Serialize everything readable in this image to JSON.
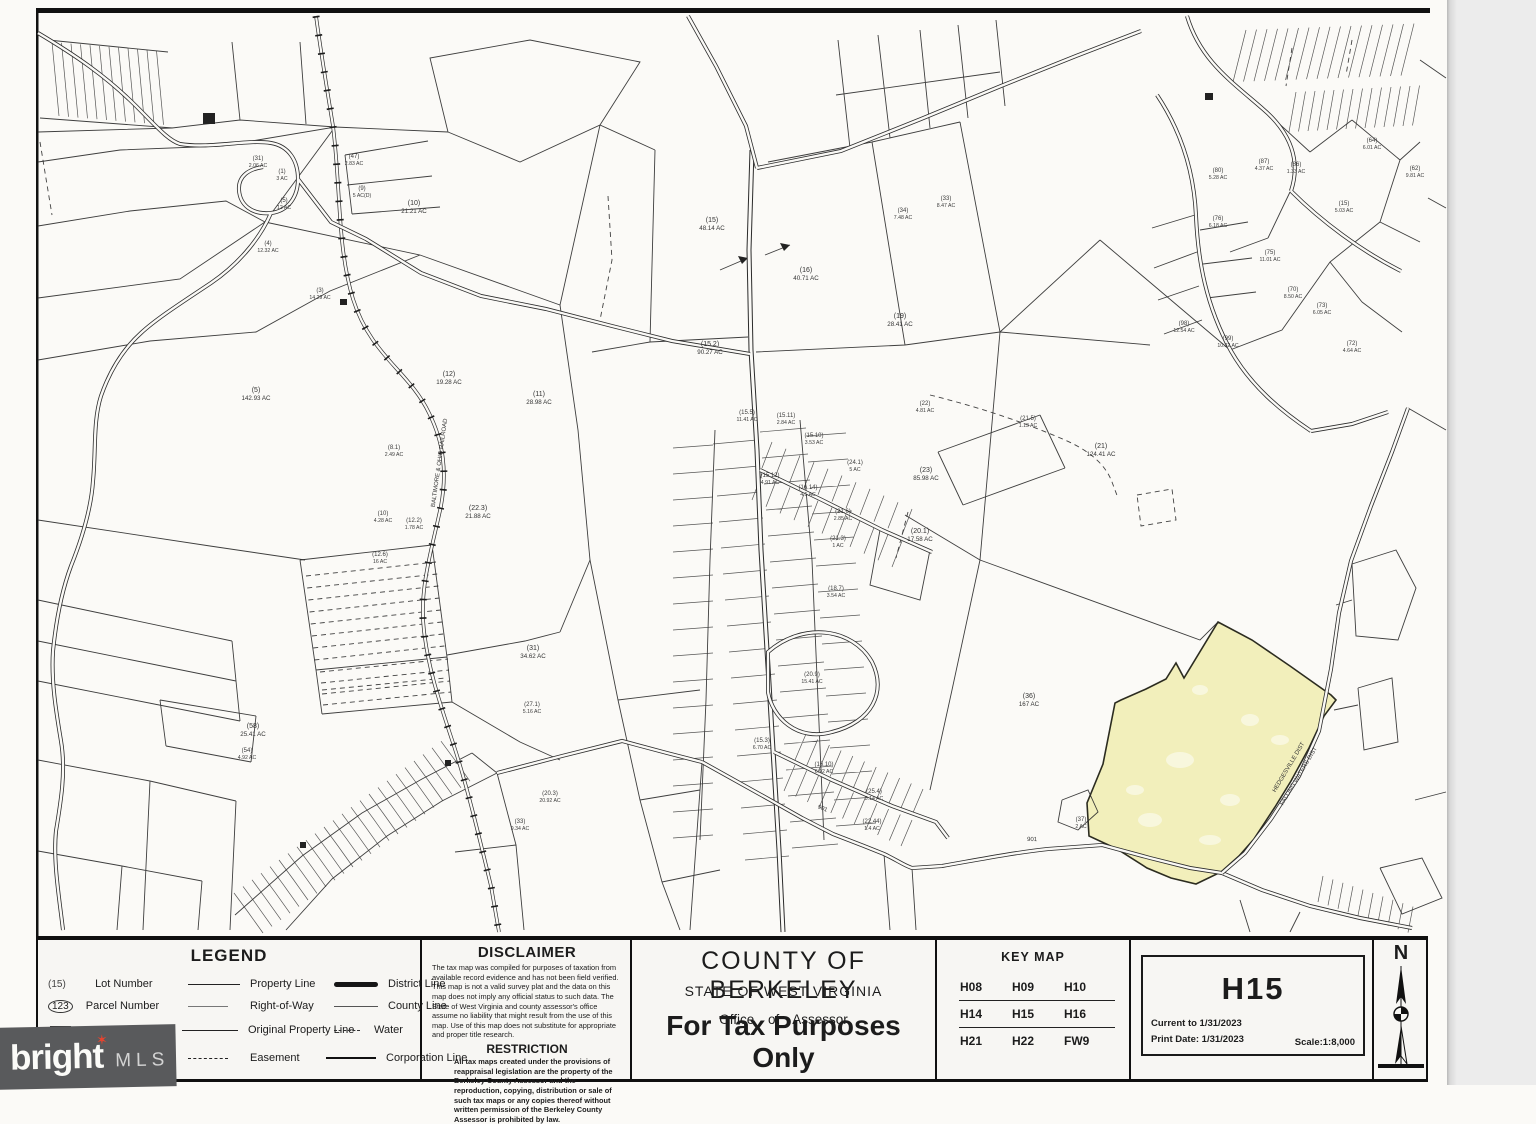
{
  "legend": {
    "title": "LEGEND",
    "symbols": [
      {
        "sym": "(15)",
        "label": "Lot Number"
      },
      {
        "sym": "123",
        "label": "Parcel Number"
      },
      {
        "sym": "12",
        "label": "Block Number"
      }
    ],
    "lines": [
      {
        "label": "Property Line"
      },
      {
        "label": "Right-of-Way"
      },
      {
        "label": "Original Property Line"
      },
      {
        "label": "Easement"
      }
    ],
    "lines2": [
      {
        "label": "District Line"
      },
      {
        "label": "County Line"
      },
      {
        "label": "Water"
      },
      {
        "label": "Corporation Line"
      }
    ]
  },
  "disclaimer": {
    "title": "DISCLAIMER",
    "body": "The tax map was compiled for purposes of taxation from available record evidence and has not been field verified.  This map is not a valid survey plat and the data on this map does not imply any official status to such data.  The State of West Virginia and county assessor's office assume no liability that might result from the use of this map. Use of this map does not substitute for appropriate and proper title research.",
    "restriction_title": "RESTRICTION",
    "restriction_body": "All tax maps created under the provisions of reappraisal legislation are the property of the Berkeley County Assessor and the reproduction, copying, distribution or sale of such tax maps or any copies thereof without written permission of the Berkeley County Assessor is prohibited by law."
  },
  "title_block": {
    "county": "COUNTY OF BERKELEY",
    "state": "STATE OF WEST VIRGINIA",
    "office": "Office of Assessor",
    "tax_note": "For Tax Purposes Only"
  },
  "key_map": {
    "title": "KEY MAP",
    "rows": [
      [
        "H08",
        "H09",
        "H10"
      ],
      [
        "H14",
        "H15",
        "H16"
      ],
      [
        "H21",
        "H22",
        "FW9"
      ]
    ]
  },
  "sheet": {
    "id": "H15",
    "current_to": "Current to 1/31/2023",
    "print_date": "Print Date: 1/31/2023",
    "scale": "Scale:1:8,000"
  },
  "north": {
    "label": "N"
  },
  "watermark": {
    "brand": "bright",
    "suffix": "MLS"
  },
  "map": {
    "highlight_color": "#f2efbb",
    "parcel_labels": [
      {
        "n": "(31)",
        "a": "2.06 AC",
        "x": 258,
        "y": 160
      },
      {
        "n": "(1)",
        "a": "3 AC",
        "x": 282,
        "y": 173
      },
      {
        "n": "(5)",
        "a": "12 AC",
        "x": 284,
        "y": 202
      },
      {
        "n": "(4)",
        "a": "12.32 AC",
        "x": 268,
        "y": 245
      },
      {
        "n": "(3)",
        "a": "14.29 AC",
        "x": 320,
        "y": 292
      },
      {
        "n": "(47)",
        "a": "2.83 AC",
        "x": 354,
        "y": 158
      },
      {
        "n": "(9)",
        "a": "5 AC(D)",
        "x": 362,
        "y": 190
      },
      {
        "n": "(10)",
        "a": "21.21 AC",
        "x": 414,
        "y": 205,
        "b": 1
      },
      {
        "n": "(5)",
        "a": "142.93 AC",
        "x": 256,
        "y": 392,
        "b": 1
      },
      {
        "n": "(12)",
        "a": "19.28 AC",
        "x": 449,
        "y": 376,
        "b": 1
      },
      {
        "n": "(11)",
        "a": "28.98 AC",
        "x": 539,
        "y": 396,
        "b": 1
      },
      {
        "n": "(8.1)",
        "a": "2.49 AC",
        "x": 394,
        "y": 449
      },
      {
        "n": "(10)",
        "a": "4.28 AC",
        "x": 383,
        "y": 515
      },
      {
        "n": "(12.2)",
        "a": "1.78 AC",
        "x": 414,
        "y": 522
      },
      {
        "n": "(22.3)",
        "a": "21.88 AC",
        "x": 478,
        "y": 510,
        "b": 1
      },
      {
        "n": "(12.6)",
        "a": "16 AC",
        "x": 380,
        "y": 556
      },
      {
        "n": "(15)",
        "a": "48.14 AC",
        "x": 712,
        "y": 222,
        "b": 1
      },
      {
        "n": "(16)",
        "a": "40.71 AC",
        "x": 806,
        "y": 272,
        "b": 1
      },
      {
        "n": "(19)",
        "a": "28.41 AC",
        "x": 900,
        "y": 318,
        "b": 1
      },
      {
        "n": "(15.2)",
        "a": "90.27 AC",
        "x": 710,
        "y": 346,
        "b": 1
      },
      {
        "n": "(34)",
        "a": "7.48 AC",
        "x": 903,
        "y": 212
      },
      {
        "n": "(33)",
        "a": "8.47 AC",
        "x": 946,
        "y": 200
      },
      {
        "n": "(22)",
        "a": "4.81 AC",
        "x": 925,
        "y": 405
      },
      {
        "n": "(23)",
        "a": "85.98 AC",
        "x": 926,
        "y": 472,
        "b": 1
      },
      {
        "n": "(21)",
        "a": "124.41 AC",
        "x": 1101,
        "y": 448,
        "b": 1
      },
      {
        "n": "(20.1)",
        "a": "17.58 AC",
        "x": 920,
        "y": 533,
        "b": 1
      },
      {
        "n": "(36)",
        "a": "167 AC",
        "x": 1029,
        "y": 698,
        "b": 1
      },
      {
        "n": "(37)",
        "a": "2 AC",
        "x": 1081,
        "y": 821
      },
      {
        "n": "(21.5)",
        "a": "1.13 AC",
        "x": 1028,
        "y": 420
      },
      {
        "n": "(80)",
        "a": "5.28 AC",
        "x": 1218,
        "y": 172
      },
      {
        "n": "(87)",
        "a": "4.37 AC",
        "x": 1264,
        "y": 163
      },
      {
        "n": "(86)",
        "a": "1.33 AC",
        "x": 1296,
        "y": 166
      },
      {
        "n": "(76)",
        "a": "6.18 AC",
        "x": 1218,
        "y": 220
      },
      {
        "n": "(75)",
        "a": "11.01 AC",
        "x": 1270,
        "y": 254
      },
      {
        "n": "(70)",
        "a": "8.50 AC",
        "x": 1293,
        "y": 291
      },
      {
        "n": "(73)",
        "a": "6.05 AC",
        "x": 1322,
        "y": 307
      },
      {
        "n": "(98)",
        "a": "12.54 AC",
        "x": 1184,
        "y": 325
      },
      {
        "n": "(99)",
        "a": "10.32 AC",
        "x": 1228,
        "y": 340
      },
      {
        "n": "(15)",
        "a": "5.03 AC",
        "x": 1344,
        "y": 205
      },
      {
        "n": "(64)",
        "a": "6.01 AC",
        "x": 1372,
        "y": 142
      },
      {
        "n": "(62)",
        "a": "9.81 AC",
        "x": 1415,
        "y": 170
      },
      {
        "n": "(72)",
        "a": "4.64 AC",
        "x": 1352,
        "y": 345
      },
      {
        "n": "(15.5)",
        "a": "11.41 AC",
        "x": 747,
        "y": 414
      },
      {
        "n": "(15.11)",
        "a": "2.84 AC",
        "x": 786,
        "y": 417
      },
      {
        "n": "(15.10)",
        "a": "3.53 AC",
        "x": 814,
        "y": 437
      },
      {
        "n": "(24.1)",
        "a": "5 AC",
        "x": 855,
        "y": 464
      },
      {
        "n": "(15.12)",
        "a": "4.91 AC",
        "x": 770,
        "y": 477
      },
      {
        "n": "(16.14)",
        "a": "4.5 AC",
        "x": 808,
        "y": 489
      },
      {
        "n": "(21.6)",
        "a": "2.85 AC",
        "x": 843,
        "y": 513
      },
      {
        "n": "(21.3)",
        "a": "1 AC",
        "x": 838,
        "y": 540
      },
      {
        "n": "(18.7)",
        "a": "3.54 AC",
        "x": 836,
        "y": 590
      },
      {
        "n": "(20.9)",
        "a": "15.41 AC",
        "x": 812,
        "y": 676
      },
      {
        "n": "(16.10)",
        "a": "6.92 AC",
        "x": 824,
        "y": 766
      },
      {
        "n": "(15.3)",
        "a": "6.70 AC",
        "x": 762,
        "y": 742
      },
      {
        "n": "(25.4)",
        "a": "8.14 AC",
        "x": 874,
        "y": 793
      },
      {
        "n": "(22.44)",
        "a": "1.4 AC",
        "x": 872,
        "y": 823
      },
      {
        "n": "(31)",
        "a": "34.62 AC",
        "x": 533,
        "y": 650,
        "b": 1
      },
      {
        "n": "(27.1)",
        "a": "5.16 AC",
        "x": 532,
        "y": 706
      },
      {
        "n": "(20.3)",
        "a": "20.92 AC",
        "x": 550,
        "y": 795
      },
      {
        "n": "(33)",
        "a": "9.34 AC",
        "x": 520,
        "y": 823
      },
      {
        "n": "(58)",
        "a": "25.41 AC",
        "x": 253,
        "y": 728,
        "b": 1
      },
      {
        "n": "(54)",
        "a": "4.92 AC",
        "x": 247,
        "y": 752
      }
    ],
    "road_labels": [
      {
        "text": "BALTIMORE & OHIO RAILROAD",
        "x": 441,
        "y": 463,
        "r": -82,
        "s": 6
      },
      {
        "text": "HEDGESVILLE DIST",
        "x": 1290,
        "y": 768,
        "r": -59,
        "s": 6
      },
      {
        "text": "FALLING WATERS DIST",
        "x": 1300,
        "y": 777,
        "r": -59,
        "s": 6
      },
      {
        "text": "901",
        "x": 822,
        "y": 810,
        "r": 22,
        "s": 6
      },
      {
        "text": "901",
        "x": 1032,
        "y": 841,
        "r": 2,
        "s": 6
      }
    ]
  }
}
